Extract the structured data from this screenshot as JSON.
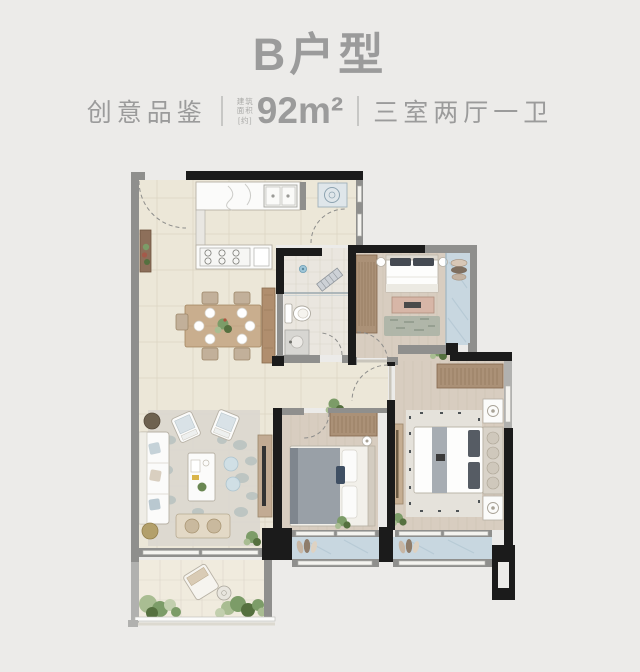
{
  "page": {
    "background": "#ecebe9"
  },
  "header": {
    "title": "B户型",
    "series_label": "创意品鉴",
    "area_note_lines": [
      "建筑",
      "面积",
      "[约]"
    ],
    "area_value": "92m²",
    "layout_label": "三室两厅一卫",
    "text_color": "#9b9b9b"
  },
  "palette": {
    "bg": "#ecebe9",
    "textGray": "#9b9b9b",
    "wallDark": "#1b1b1b",
    "wallGray": "#8f8f8d",
    "wallSoft": "#b1b1af",
    "floorMain": "#ece7d8",
    "floorLine": "#ddd6c4",
    "floorBath": "#eae6df",
    "floorWood": "#d8cdc0",
    "floorWoodLine": "#c9bcad",
    "floorBalcony": "#c8d7e0",
    "balconyVein": "#aec3d0",
    "floorGarden": "#f0ebde",
    "white": "#fbfbfa",
    "furnitureEdge": "#b7b1a5",
    "woodWarm": "#c9ae8e",
    "woodDark": "#a3855f",
    "wardrobe": "#ab9177",
    "wardrobeLine": "#84664c",
    "fabricGray": "#99a0a7",
    "fabricDark": "#565c64",
    "blush": "#d7b6a7",
    "greenLeaf": "#7c9c68",
    "greenDark": "#55703f",
    "stoneGray": "#b0bcbd",
    "glassBlue": "#9fc6d8"
  }
}
